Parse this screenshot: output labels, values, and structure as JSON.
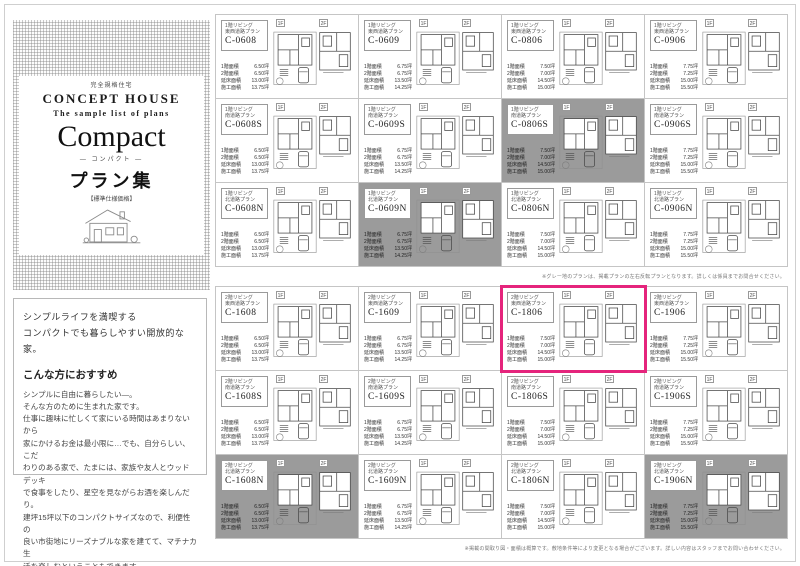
{
  "sidebar": {
    "tagline": "完全規格住宅",
    "brand": "CONCEPT HOUSE",
    "subtitle": "The sample list of plans",
    "series_title": "Compact",
    "series_kana": "― コンパクト ―",
    "collection": "プラン集",
    "spec_label": "【標準仕様価格】",
    "lead_lines": [
      "シンプルライフを満喫する",
      "コンパクトでも暮らしやすい開放的な家。"
    ],
    "recommend_heading": "こんな方におすすめ",
    "body_lines": [
      "シンプルに自由に暮らしたい―。",
      "そんな方のために生まれた家です。",
      "仕事に趣味に忙しくて家にいる時間はあまりないから",
      "家にかけるお金は最小限に…でも、自分らしい、こだ",
      "わりのある家で、たまには、家族や友人とウッドデッキ",
      "で食事をしたり、星空を見ながらお酒を楽しんだり。",
      "建坪15坪以下のコンパクトサイズなので、利便性の",
      "良い市街地にリーズナブルな家を建てて、マチナカ生",
      "活を楽しむということもできます。"
    ]
  },
  "plans": {
    "stat_labels": [
      "1階面積",
      "2階面積",
      "延床面積",
      "施工面積"
    ],
    "floor_tags": [
      "1F",
      "2F"
    ],
    "accent_color": "#e5247c",
    "gray_color": "#9b9b9b",
    "cards": [
      {
        "code": "C-0608",
        "living": "1階リビング",
        "road": "東西道路プラン",
        "style": "white",
        "stats": [
          "6.50坪",
          "6.50坪",
          "13.00坪",
          "13.75坪"
        ]
      },
      {
        "code": "C-0609",
        "living": "1階リビング",
        "road": "東西道路プラン",
        "style": "white",
        "stats": [
          "6.75坪",
          "6.75坪",
          "13.50坪",
          "14.25坪"
        ]
      },
      {
        "code": "C-0806",
        "living": "1階リビング",
        "road": "東西道路プラン",
        "style": "white",
        "stats": [
          "7.50坪",
          "7.00坪",
          "14.50坪",
          "15.00坪"
        ]
      },
      {
        "code": "C-0906",
        "living": "1階リビング",
        "road": "東西道路プラン",
        "style": "white",
        "stats": [
          "7.75坪",
          "7.25坪",
          "15.00坪",
          "15.50坪"
        ]
      },
      {
        "code": "C-0608S",
        "living": "1階リビング",
        "road": "南道路プラン",
        "style": "white",
        "stats": [
          "6.50坪",
          "6.50坪",
          "13.00坪",
          "13.75坪"
        ]
      },
      {
        "code": "C-0609S",
        "living": "1階リビング",
        "road": "南道路プラン",
        "style": "white",
        "stats": [
          "6.75坪",
          "6.75坪",
          "13.50坪",
          "14.25坪"
        ]
      },
      {
        "code": "C-0806S",
        "living": "1階リビング",
        "road": "南道路プラン",
        "style": "gray",
        "stats": [
          "7.50坪",
          "7.00坪",
          "14.50坪",
          "15.00坪"
        ]
      },
      {
        "code": "C-0906S",
        "living": "1階リビング",
        "road": "南道路プラン",
        "style": "white",
        "stats": [
          "7.75坪",
          "7.25坪",
          "15.00坪",
          "15.50坪"
        ]
      },
      {
        "code": "C-0608N",
        "living": "1階リビング",
        "road": "北道路プラン",
        "style": "white",
        "stats": [
          "6.50坪",
          "6.50坪",
          "13.00坪",
          "13.75坪"
        ]
      },
      {
        "code": "C-0609N",
        "living": "1階リビング",
        "road": "北道路プラン",
        "style": "gray",
        "stats": [
          "6.75坪",
          "6.75坪",
          "13.50坪",
          "14.25坪"
        ]
      },
      {
        "code": "C-0806N",
        "living": "1階リビング",
        "road": "北道路プラン",
        "style": "white",
        "stats": [
          "7.50坪",
          "7.00坪",
          "14.50坪",
          "15.00坪"
        ]
      },
      {
        "code": "C-0906N",
        "living": "1階リビング",
        "road": "北道路プラン",
        "style": "white",
        "stats": [
          "7.75坪",
          "7.25坪",
          "15.00坪",
          "15.50坪"
        ]
      },
      {
        "code": "C-1608",
        "living": "2階リビング",
        "road": "東西道路プラン",
        "style": "white",
        "stats": [
          "6.50坪",
          "6.50坪",
          "13.00坪",
          "13.75坪"
        ]
      },
      {
        "code": "C-1609",
        "living": "2階リビング",
        "road": "東西道路プラン",
        "style": "white",
        "stats": [
          "6.75坪",
          "6.75坪",
          "13.50坪",
          "14.25坪"
        ]
      },
      {
        "code": "C-1806",
        "living": "2階リビング",
        "road": "東西道路プラン",
        "style": "highlight",
        "stats": [
          "7.50坪",
          "7.00坪",
          "14.50坪",
          "15.00坪"
        ]
      },
      {
        "code": "C-1906",
        "living": "2階リビング",
        "road": "東西道路プラン",
        "style": "white",
        "stats": [
          "7.75坪",
          "7.25坪",
          "15.00坪",
          "15.50坪"
        ]
      },
      {
        "code": "C-1608S",
        "living": "2階リビング",
        "road": "南道路プラン",
        "style": "white",
        "stats": [
          "6.50坪",
          "6.50坪",
          "13.00坪",
          "13.75坪"
        ]
      },
      {
        "code": "C-1609S",
        "living": "2階リビング",
        "road": "南道路プラン",
        "style": "white",
        "stats": [
          "6.75坪",
          "6.75坪",
          "13.50坪",
          "14.25坪"
        ]
      },
      {
        "code": "C-1806S",
        "living": "2階リビング",
        "road": "南道路プラン",
        "style": "white",
        "stats": [
          "7.50坪",
          "7.00坪",
          "14.50坪",
          "15.00坪"
        ]
      },
      {
        "code": "C-1906S",
        "living": "2階リビング",
        "road": "南道路プラン",
        "style": "white",
        "stats": [
          "7.75坪",
          "7.25坪",
          "15.00坪",
          "15.50坪"
        ]
      },
      {
        "code": "C-1608N",
        "living": "2階リビング",
        "road": "北道路プラン",
        "style": "gray",
        "stats": [
          "6.50坪",
          "6.50坪",
          "13.00坪",
          "13.75坪"
        ]
      },
      {
        "code": "C-1609N",
        "living": "2階リビング",
        "road": "北道路プラン",
        "style": "white",
        "stats": [
          "6.75坪",
          "6.75坪",
          "13.50坪",
          "14.25坪"
        ]
      },
      {
        "code": "C-1806N",
        "living": "2階リビング",
        "road": "北道路プラン",
        "style": "white",
        "stats": [
          "7.50坪",
          "7.00坪",
          "14.50坪",
          "15.00坪"
        ]
      },
      {
        "code": "C-1906N",
        "living": "2階リビング",
        "road": "北道路プラン",
        "style": "gray",
        "stats": [
          "7.75坪",
          "7.25坪",
          "15.00坪",
          "15.50坪"
        ]
      }
    ]
  },
  "footnotes": {
    "mid": "※グレー地のプランは、掲載プランの左右反転プランとなります。詳しくは係員までお問合せください。",
    "bottom": "※掲載の間取り図・面積は概算です。敷地条件等により変更となる場合がございます。詳しい内容はスタッフまでお問い合わせください。"
  }
}
